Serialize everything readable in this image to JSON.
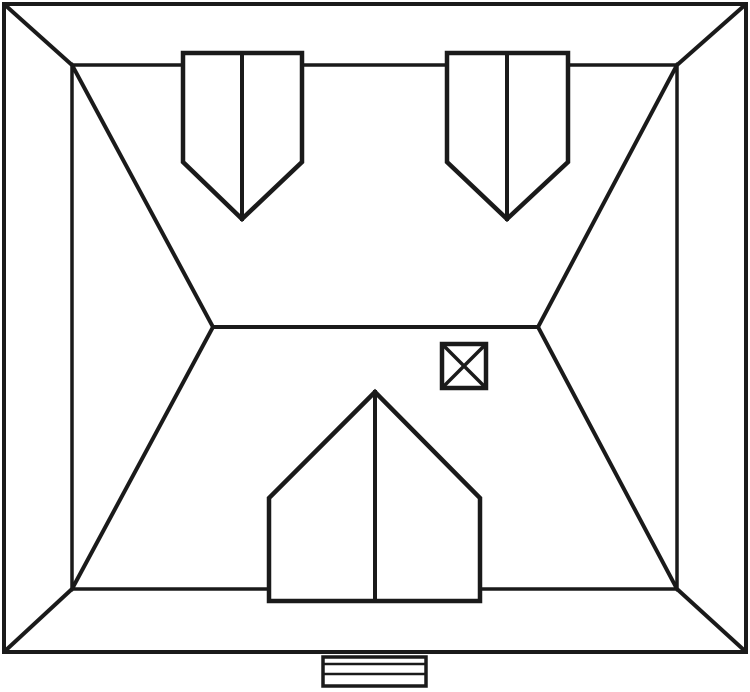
{
  "style": {
    "background_color": "#ffffff",
    "line_color": "#1a1a1a",
    "default_stroke_width": 4,
    "fill_white": "#ffffff"
  },
  "diagram": {
    "subject": "house-roof-plan-top-view",
    "canvas": {
      "width": 750,
      "height": 692
    },
    "shapes": [
      {
        "name": "outer-wall-outline",
        "type": "rect",
        "x": 4,
        "y": 4,
        "w": 742,
        "h": 648,
        "fill": "none",
        "stroke_width": 4
      },
      {
        "name": "corner-miter-top-left",
        "type": "line",
        "x1": 5,
        "y1": 5,
        "x2": 72,
        "y2": 65,
        "stroke_width": 4
      },
      {
        "name": "corner-miter-top-right",
        "type": "line",
        "x1": 745,
        "y1": 5,
        "x2": 677,
        "y2": 65,
        "stroke_width": 4
      },
      {
        "name": "corner-miter-bottom-left",
        "type": "line",
        "x1": 5,
        "y1": 651,
        "x2": 72,
        "y2": 589,
        "stroke_width": 4
      },
      {
        "name": "corner-miter-bottom-right",
        "type": "line",
        "x1": 745,
        "y1": 651,
        "x2": 677,
        "y2": 589,
        "stroke_width": 4
      },
      {
        "name": "eave-outline",
        "type": "rect",
        "x": 72,
        "y": 65,
        "w": 605,
        "h": 524,
        "fill": "none",
        "stroke_width": 3.5
      },
      {
        "name": "hip-line-top-left",
        "type": "line",
        "x1": 72,
        "y1": 65,
        "x2": 213,
        "y2": 327,
        "stroke_width": 4
      },
      {
        "name": "hip-line-bottom-left",
        "type": "line",
        "x1": 72,
        "y1": 589,
        "x2": 213,
        "y2": 327,
        "stroke_width": 4
      },
      {
        "name": "hip-line-top-right",
        "type": "line",
        "x1": 677,
        "y1": 65,
        "x2": 538,
        "y2": 327,
        "stroke_width": 4
      },
      {
        "name": "hip-line-bottom-right",
        "type": "line",
        "x1": 677,
        "y1": 589,
        "x2": 538,
        "y2": 327,
        "stroke_width": 4
      },
      {
        "name": "ridge-line",
        "type": "line",
        "x1": 213,
        "y1": 327,
        "x2": 538,
        "y2": 327,
        "stroke_width": 4
      },
      {
        "name": "dormer-top-left-outline",
        "type": "polygon",
        "points": [
          [
            183,
            53
          ],
          [
            302,
            53
          ],
          [
            302,
            162
          ],
          [
            242,
            219
          ],
          [
            183,
            162
          ]
        ],
        "fill": "#ffffff",
        "stroke_width": 4.5
      },
      {
        "name": "dormer-top-left-ridge-line",
        "type": "line",
        "x1": 242,
        "y1": 53,
        "x2": 242,
        "y2": 219,
        "stroke_width": 4
      },
      {
        "name": "dormer-top-right-outline",
        "type": "polygon",
        "points": [
          [
            447,
            53
          ],
          [
            568,
            53
          ],
          [
            568,
            162
          ],
          [
            507,
            219
          ],
          [
            447,
            162
          ]
        ],
        "fill": "#ffffff",
        "stroke_width": 4.5
      },
      {
        "name": "dormer-top-right-ridge-line",
        "type": "line",
        "x1": 507,
        "y1": 53,
        "x2": 507,
        "y2": 219,
        "stroke_width": 4
      },
      {
        "name": "dormer-bottom-outline",
        "type": "polygon",
        "points": [
          [
            269,
            601
          ],
          [
            269,
            498
          ],
          [
            375,
            392
          ],
          [
            480,
            498
          ],
          [
            480,
            601
          ]
        ],
        "fill": "#ffffff",
        "stroke_width": 4.5
      },
      {
        "name": "dormer-bottom-ridge-line",
        "type": "line",
        "x1": 375,
        "y1": 392,
        "x2": 375,
        "y2": 601,
        "stroke_width": 4
      },
      {
        "name": "chimney-outline",
        "type": "rect",
        "x": 442,
        "y": 344,
        "w": 44,
        "h": 44,
        "fill": "#ffffff",
        "stroke_width": 4.5
      },
      {
        "name": "chimney-cross-diagonal-1",
        "type": "line",
        "x1": 444,
        "y1": 346,
        "x2": 484,
        "y2": 386,
        "stroke_width": 3.5
      },
      {
        "name": "chimney-cross-diagonal-2",
        "type": "line",
        "x1": 484,
        "y1": 346,
        "x2": 444,
        "y2": 386,
        "stroke_width": 3.5
      },
      {
        "name": "entry-steps-outline",
        "type": "rect",
        "x": 323,
        "y": 657,
        "w": 103,
        "h": 29,
        "fill": "#ffffff",
        "stroke_width": 3.5
      },
      {
        "name": "entry-steps-tread-line-1",
        "type": "line",
        "x1": 323,
        "y1": 664,
        "x2": 426,
        "y2": 664,
        "stroke_width": 2.5
      },
      {
        "name": "entry-steps-tread-line-2",
        "type": "line",
        "x1": 323,
        "y1": 674,
        "x2": 426,
        "y2": 674,
        "stroke_width": 2.5
      }
    ]
  }
}
